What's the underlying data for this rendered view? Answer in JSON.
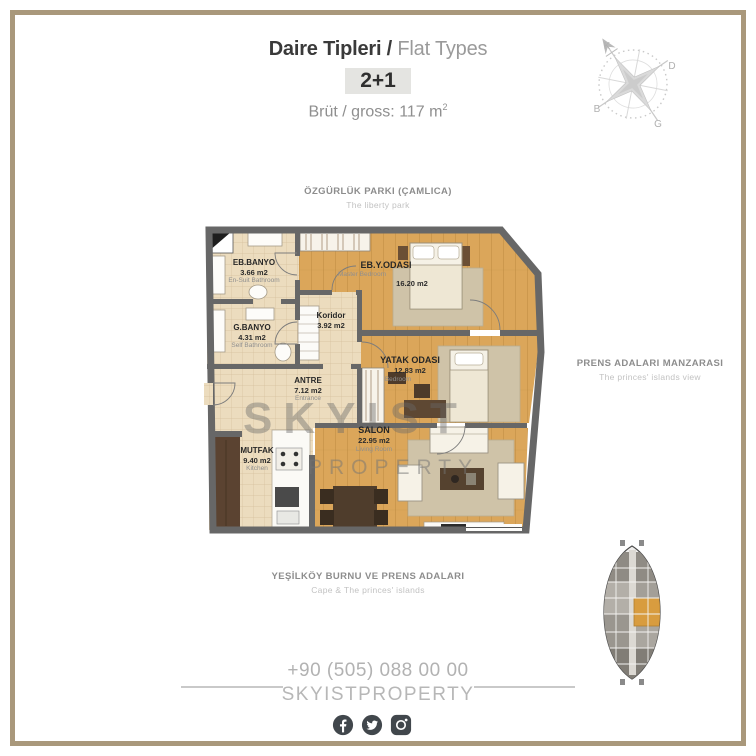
{
  "header": {
    "title_tr": "Daire Tipleri /",
    "title_en": " Flat Types",
    "type_badge": "2+1",
    "area_text": "Brüt / gross: 117 m",
    "area_sup": "2"
  },
  "compass": {
    "north": "K",
    "east": "D",
    "west": "B",
    "south": "G"
  },
  "context_labels": {
    "top": {
      "title": "ÖZGÜRLÜK PARKI (ÇAMLICA)",
      "subtitle": "The liberty park"
    },
    "right": {
      "title": "PRENS ADALARI MANZARASI",
      "subtitle": "The princes' islands view"
    },
    "bottom": {
      "title": "YEŞİLKÖY BURNU VE PRENS ADALARI",
      "subtitle": "Cape & The princes' islands"
    }
  },
  "floor_plan": {
    "watermark": {
      "line1": "SKYIST",
      "line2": "PROPERTY"
    },
    "rooms": [
      {
        "name_tr": "EB.BANYO",
        "area": "3.66 m2",
        "name_en": "En-Suit Bathroom"
      },
      {
        "name_tr": "G.BANYO",
        "area": "4.31 m2",
        "name_en": "Self Bathroom"
      },
      {
        "name_tr": "Koridor",
        "area": "3.92 m2",
        "name_en": ""
      },
      {
        "name_tr": "EB.Y.ODASI",
        "area": "16.20 m2",
        "name_en": "Master Bedroom"
      },
      {
        "name_tr": "YATAK ODASI",
        "area": "12.83 m2",
        "name_en": "Bedroom"
      },
      {
        "name_tr": "ANTRE",
        "area": "7.12 m2",
        "name_en": "Entrance"
      },
      {
        "name_tr": "SALON",
        "area": "22.95 m2",
        "name_en": "Living Room"
      },
      {
        "name_tr": "MUTFAK",
        "area": "9.40 m2",
        "name_en": "Kitchen"
      }
    ]
  },
  "footer": {
    "phone": "+90 (505) 088 00 00",
    "brand": "SKYISTPROPERTY",
    "social_icons": [
      "facebook",
      "twitter",
      "instagram"
    ]
  },
  "colors": {
    "frame": "#a9987b",
    "icon-bg": "#41474c",
    "wall": "#676767",
    "wood-floor": "#dba65a",
    "tile-floor": "#ecdcbe",
    "highlight-unit": "#d89c3f",
    "text-dark": "#3a3a3a",
    "text-gray": "#9a9a9a"
  }
}
